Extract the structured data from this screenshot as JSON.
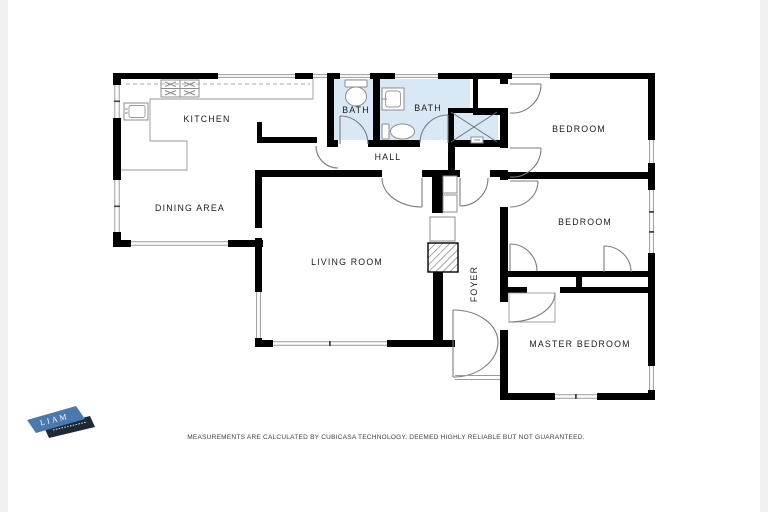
{
  "page": {
    "margin_color": "#f0f0f0"
  },
  "floorplan": {
    "labels": {
      "kitchen": "KITCHEN",
      "dining": "DINING AREA",
      "bath1": "BATH",
      "bath2": "BATH",
      "hall": "HALL",
      "bedroom1": "BEDROOM",
      "bedroom2": "BEDROOM",
      "living": "LIVING ROOM",
      "foyer": "FOYER",
      "master": "MASTER BEDROOM"
    },
    "disclaimer": "MEASUREMENTS ARE CALCULATED BY CUBICASA TECHNOLOGY. DEEMED HIGHLY RELIABLE BUT NOT GUARANTEED.",
    "colors": {
      "wall": "#000000",
      "bath_fill": "#d9e8f5",
      "door_stroke": "#7c7c7c",
      "window_stroke": "#9b9b9b"
    }
  },
  "logo": {
    "text": "LIAM",
    "blue": "#4a79ad",
    "dark": "#1d2937"
  }
}
